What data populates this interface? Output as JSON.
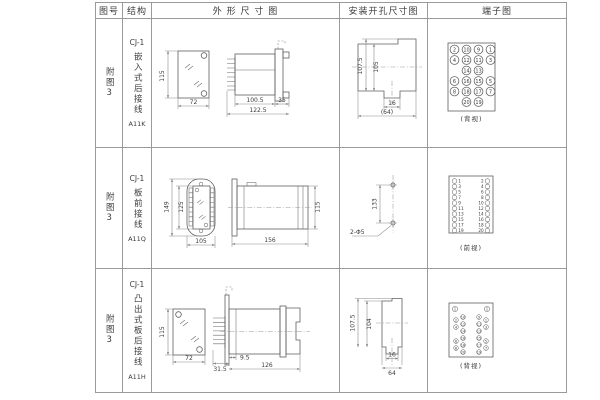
{
  "header": {
    "figure": "图号",
    "structure": "结构",
    "outline": "外 形 尺 寸 图",
    "mounting": "安装开孔尺寸图",
    "terminal": "端子图"
  },
  "rows": [
    {
      "figure": "附图3",
      "model": "CJ-1",
      "desc": "嵌入式后接线",
      "code": "A11K",
      "dims": {
        "front_h": "115",
        "front_w": "72",
        "body_len": "100.5",
        "flange_len": "35",
        "total_len": "122.5"
      },
      "mount": {
        "outer_h": "107.5",
        "inner_h": "105",
        "slot_w": "16",
        "cutout_w": "(64)"
      },
      "terminal": {
        "label": "(背视)",
        "grid": [
          [
            "2",
            "10",
            "9",
            "1"
          ],
          [
            "4",
            "12",
            "11",
            "3"
          ],
          [
            "",
            "14",
            "13",
            ""
          ],
          [
            "6",
            "16",
            "15",
            "5"
          ],
          [
            "8",
            "18",
            "17",
            "7"
          ],
          [
            "",
            "20",
            "19",
            ""
          ]
        ]
      }
    },
    {
      "figure": "附图3",
      "model": "CJ-1",
      "desc": "板前接线",
      "code": "A11Q",
      "dims": {
        "outer_h": "149",
        "inner_h": "125",
        "width": "105",
        "side_len": "156",
        "side_h": "115"
      },
      "mount": {
        "pitch": "133",
        "holes": "2-Φ5"
      },
      "terminal": {
        "label": "(前视)",
        "left": [
          "1",
          "3",
          "5",
          "7",
          "9",
          "11",
          "13",
          "15",
          "17",
          "19"
        ],
        "right": [
          "2",
          "4",
          "6",
          "8",
          "10",
          "12",
          "14",
          "16",
          "18",
          "20"
        ]
      }
    },
    {
      "figure": "附图3",
      "model": "CJ-1",
      "desc": "凸出式板后接线",
      "code": "A11H",
      "dims": {
        "front_h": "115",
        "front_w": "72",
        "pin_len": "31.5",
        "bezel": "9.5",
        "body_len": "126"
      },
      "mount": {
        "outer_h": "107.5",
        "inner_h": "104",
        "slot_w": "16",
        "cutout_w": "64"
      },
      "terminal": {
        "label": "(背视)",
        "grid": [
          [
            "2",
            "10",
            "9",
            "1"
          ],
          [
            "4",
            "12",
            "11",
            "3"
          ],
          [
            "",
            "14",
            "13",
            ""
          ],
          [
            "6",
            "16",
            "15",
            "5"
          ],
          [
            "8",
            "18",
            "17",
            "7"
          ],
          [
            "",
            "20",
            "19",
            ""
          ]
        ]
      }
    }
  ]
}
